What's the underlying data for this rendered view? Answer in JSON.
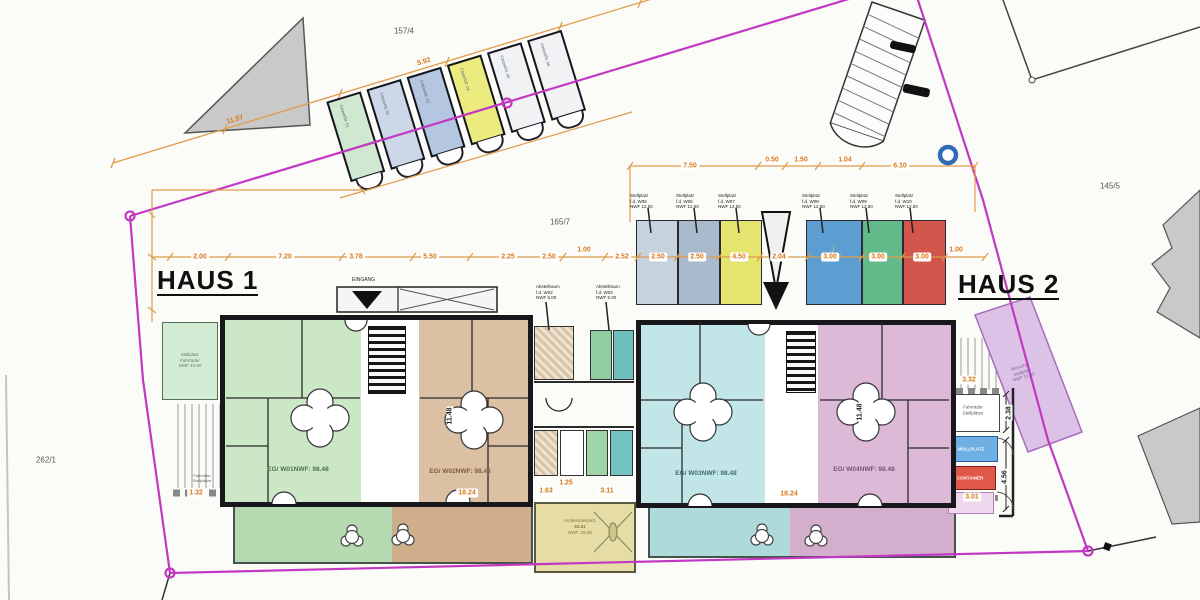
{
  "colors": {
    "boundary": "#c238c2",
    "dimension_text": "#d97818"
  },
  "titles": {
    "haus1": "HAUS 1",
    "haus2": "HAUS 2"
  },
  "parcels": {
    "p1": "157/4",
    "p2": "165/7",
    "p3": "145/5",
    "p4": "262/1"
  },
  "entrance_label": "EINGANG",
  "units": {
    "w01n": "EG/ W01",
    "w01a": "NWF: 98.48",
    "w02n": "EG/ W02",
    "w02a": "NWF: 98.48",
    "w03n": "EG/ W03",
    "w03a": "NWF: 98.48",
    "w04n": "EG/ W04",
    "w04a": "NWF: 98.48"
  },
  "dims_main": [
    "2.00",
    "7.20",
    "3.78",
    "5.50",
    "2.25",
    "2.50",
    "1.00",
    "2.52",
    "2.50",
    "2.50",
    "4.50",
    "2.04",
    "3.00",
    "3.00",
    "3.00",
    "1.00"
  ],
  "dims_top": [
    "7.50",
    "0.50",
    "1.50",
    "1.04",
    "6.10"
  ],
  "dims": {
    "d132": "1.32",
    "d1824a": "18.24",
    "d163": "1.63",
    "d125": "1.25",
    "d311": "3.11",
    "d1824b": "18.24",
    "d332": "3.32",
    "d301": "3.01",
    "v1": "11.48",
    "v2": "11.48",
    "v3": "2.38",
    "v4": "4.56",
    "diag1": "11.97",
    "diag2": "5.92"
  },
  "stall_labels": [
    {
      "l1": "Stellplatz",
      "l2": "f.d. W05",
      "l3": "NWF 12.50"
    },
    {
      "l1": "Stellplatz",
      "l2": "f.d. W06",
      "l3": "NWF 12.50"
    },
    {
      "l1": "Stellplatz",
      "l2": "f.d. W07",
      "l3": "NWF 12.50"
    },
    {
      "l1": "Stellplatz",
      "l2": "f.d. W08",
      "l3": "NWF 12.50"
    },
    {
      "l1": "Stellplatz",
      "l2": "f.d. W09",
      "l3": "NWF 12.50"
    },
    {
      "l1": "Stellplatz",
      "l2": "f.d. W10",
      "l3": "NWF 12.50"
    }
  ],
  "storage_labels": [
    {
      "l1": "Abstellraum",
      "l2": "f.d. W02",
      "l3": "NWF 5.00"
    },
    {
      "l1": "Abstellraum",
      "l2": "f.d. W03",
      "l3": "NWF 5.00"
    }
  ],
  "annex": {
    "l1": "Müllplatz",
    "l2": "Fahrräder",
    "l3": "NWF 10.50"
  },
  "left_fence": {
    "l1": "Fahrräder",
    "l2": "Stellplätze"
  },
  "right_box": {
    "l1": "Fahrräder",
    "l2": "Stellplätze"
  },
  "blue_box_label": "MÜLLPLATZ",
  "red_box_label": "CONTAINER",
  "visitor": {
    "l1": "Besucher",
    "l2": "Stellplatz",
    "l3": "NWF 12.00"
  },
  "playground": {
    "l1": "Kinderspielplatz",
    "l2": "63.51",
    "l3": "NWF: 28.90"
  },
  "carports": [
    {
      "n": "Carport",
      "w": "St. 01"
    },
    {
      "n": "Carport",
      "w": "St. 02"
    },
    {
      "n": "Carport",
      "w": "St. 03"
    },
    {
      "n": "Carport",
      "w": "St. 04"
    },
    {
      "n": "Carport",
      "w": "St. 05"
    },
    {
      "n": "Carport",
      "w": "St. 06"
    }
  ],
  "anchor_icon": "⚓"
}
